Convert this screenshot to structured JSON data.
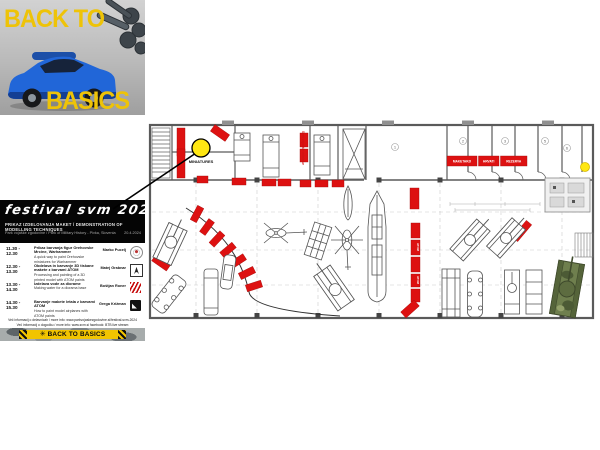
{
  "poster": {
    "back_to": "BACK TO",
    "basics": "BASICS",
    "title": "festival svm 2024",
    "subtitle": "PRIKAZ IZDELOVANJA MAKET / DEMONSTRATION OF MODELLING TECHNIQUES",
    "venue": "Park vojaške zgodovine / Park of Military History - Pivka, Slovenia",
    "date": "20.4.2024",
    "schedule": [
      {
        "time": "11.30 - 12.30",
        "line1": "Prikaz barvanja figur Orehovske Mrcine, Warhammer",
        "line2": "A quick way to paint Orehovske miniatures for Warhammer",
        "presenter": "Marko Pucelj"
      },
      {
        "time": "12.30 - 13.30",
        "line1": "Obdelava in barvanje 3D tiskane makete z barvami ATOM",
        "line2": "Processing and painting of a 3D printed model with ATOM paints",
        "presenter": "Matej Grabnar"
      },
      {
        "time": "13.30 - 14.30",
        "line1": "Izdelava vode za diorame",
        "line2": "Making water for a diorama base",
        "presenter": "Boštjan Roner"
      },
      {
        "time": "14.30 - 15.30",
        "line1": "Barvanje makete letala z barvami ATOM",
        "line2": "How to paint model airplanes with ATOM paints",
        "presenter": "Grega Križman"
      }
    ],
    "footer_line1": "Več informacij o delavnicah / more info: www.parkvojaskezgodovine.si/festival-svm-2024",
    "footer_line2": "Več informacij o dogodku / more info: www.svm.si  facebook: BTB live stream",
    "banner_brand": "BACK TO BASICS"
  },
  "plan": {
    "miniatures_label": "MINIATURES",
    "side_label": "Svet vojaških miniatur",
    "table_labels": [
      "MAKETARJI",
      "HRVATI",
      "REZERVA"
    ],
    "strip_label": "ATOM",
    "rooms": [
      {
        "num": "1"
      },
      {
        "num": "2"
      },
      {
        "num": "3"
      },
      {
        "num": "5"
      },
      {
        "num": "6"
      }
    ]
  },
  "icons": {
    "wheel": "✳"
  },
  "colors": {
    "table_red": "#dd1111",
    "brand_yellow": "#f2c400",
    "marker_yellow": "#ffe713"
  }
}
